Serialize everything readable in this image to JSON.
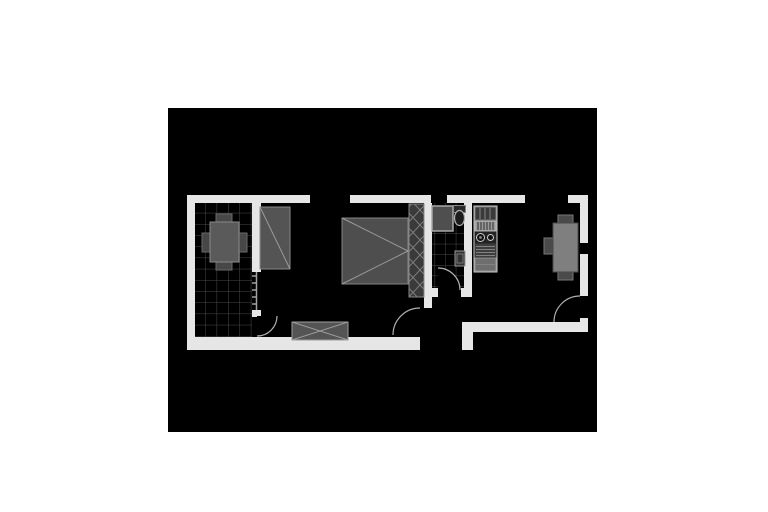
{
  "page": {
    "background": "#ffffff"
  },
  "canvas": {
    "background": "#000000"
  },
  "palette": {
    "wall": "#e6e6e6",
    "window_gap": "#000000",
    "canvas_bg": "#000000",
    "door_arc": "#b0b0b0",
    "tile_line": "#4a4a4a",
    "furniture_fill": "#525252",
    "furniture_stroke": "#8f8f8f",
    "furniture_detail_line": "#9a9a9a",
    "chair_fill": "#474747",
    "table_right_fill": "#7f7f7f",
    "kitchen_counter_light": "#9a9a9a",
    "appliance_dark": "#3a3a3a",
    "burner_ring": "#cccccc"
  },
  "plan": {
    "type": "apartment-floor-plan",
    "orientation": "horizontal",
    "rooms": [
      {
        "id": "terrace",
        "floor": "tiled-grid",
        "contents": [
          "dining-table",
          "4-chairs"
        ]
      },
      {
        "id": "living-bedroom",
        "floor": "plain",
        "contents": [
          "wardrobe",
          "double-bed",
          "hatched-closet-column",
          "sideboard"
        ]
      },
      {
        "id": "bathroom",
        "floor": "tiled-grid",
        "contents": [
          "washing-machine",
          "toilet",
          "wash-basin"
        ]
      },
      {
        "id": "entry-hall",
        "floor": "plain",
        "contents": []
      },
      {
        "id": "kitchen-dining",
        "floor": "plain",
        "contents": [
          "kitchen-counter",
          "fridge",
          "stove-two-burners",
          "oven-drawers",
          "dining-table",
          "3-chairs"
        ]
      }
    ],
    "openings": [
      {
        "id": "terrace-door",
        "type": "swing-door",
        "between": [
          "terrace",
          "living-bedroom"
        ]
      },
      {
        "id": "terrace-glazing",
        "type": "window-partition",
        "between": [
          "terrace",
          "living-bedroom"
        ]
      },
      {
        "id": "living-window",
        "type": "window",
        "wall": "top"
      },
      {
        "id": "kitchen-window",
        "type": "window",
        "wall": "top"
      },
      {
        "id": "shaft-marker",
        "type": "vent-shaft",
        "wall": "top"
      },
      {
        "id": "right-wall-vent",
        "type": "vent",
        "wall": "right"
      },
      {
        "id": "hall-door",
        "type": "swing-door",
        "between": [
          "living-bedroom",
          "entry-hall"
        ]
      },
      {
        "id": "bathroom-door",
        "type": "swing-door",
        "between": [
          "entry-hall",
          "bathroom"
        ]
      },
      {
        "id": "apartment-entry-door",
        "type": "swing-door",
        "wall": "right",
        "between": [
          "outside",
          "kitchen-dining"
        ]
      },
      {
        "id": "entry-gap",
        "type": "opening",
        "wall": "bottom"
      }
    ]
  }
}
